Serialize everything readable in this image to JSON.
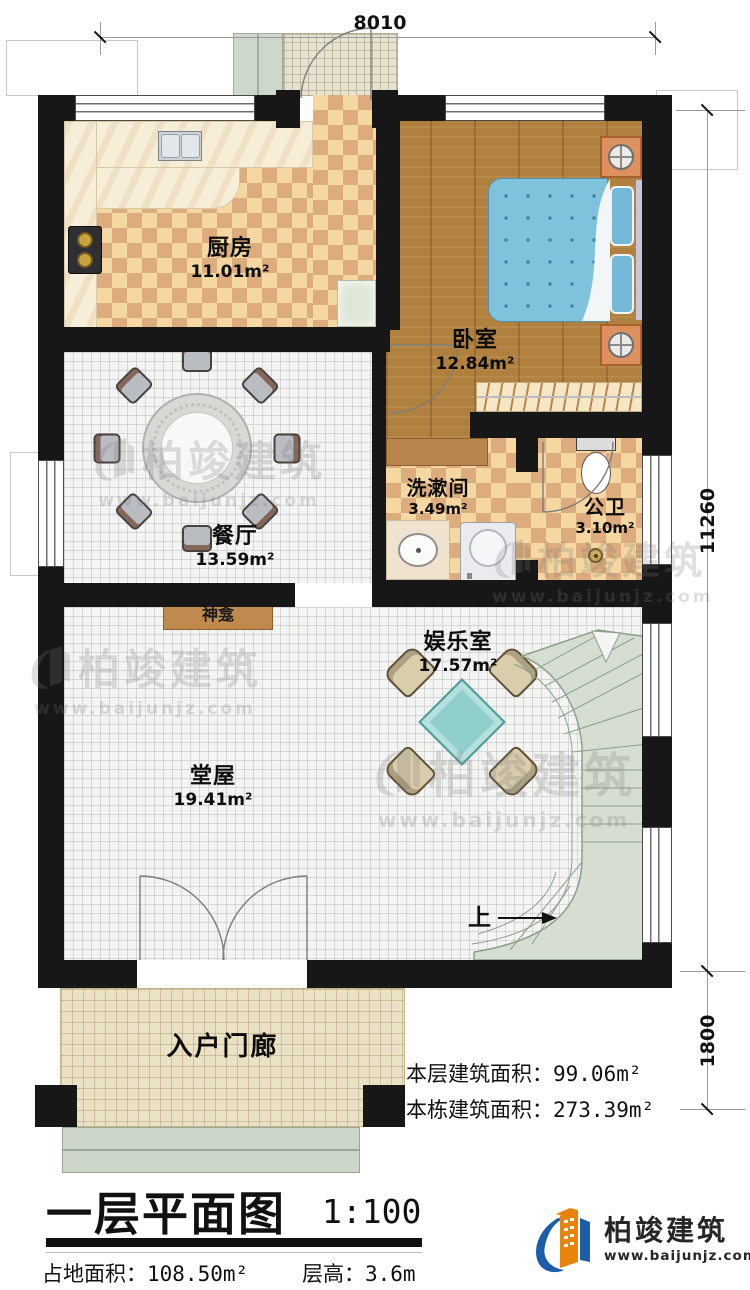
{
  "dims": {
    "top": "8010",
    "right_main": "11260",
    "right_porch": "1800"
  },
  "rooms": {
    "kitchen": {
      "name": "厨房",
      "area": "11.01m²"
    },
    "bedroom": {
      "name": "卧室",
      "area": "12.84m²"
    },
    "dining": {
      "name": "餐厅",
      "area": "13.59m²"
    },
    "washroom": {
      "name": "洗漱间",
      "area": "3.49m²"
    },
    "wc": {
      "name": "公卫",
      "area": "3.10m²"
    },
    "entertainment": {
      "name": "娱乐室",
      "area": "17.57m²"
    },
    "hall": {
      "name": "堂屋",
      "area": "19.41m²"
    },
    "porch": {
      "name": "入户门廊"
    },
    "shrine": {
      "name": "神龛"
    }
  },
  "stairs": {
    "up": "上"
  },
  "areas": {
    "floor_label": "本层建筑面积：",
    "floor_value": "99.06m²",
    "building_label": "本栋建筑面积：",
    "building_value": "273.39m²"
  },
  "titleblock": {
    "title": "一层平面图",
    "scale": "1:100",
    "land_label": "占地面积：",
    "land_value": "108.50m²",
    "height_label": "层高：",
    "height_value": "3.6m"
  },
  "brand": {
    "name": "柏竣建筑",
    "url": "www.baijunjz.com"
  },
  "watermark": {
    "name": "柏竣建筑",
    "url": "www.baijunjz.com"
  },
  "colors": {
    "wall": "#171717",
    "checker_light": "#f4d7a1",
    "checker_dark": "#dcab7e",
    "wood": "#b0803f",
    "bed_blue": "#7fc2dc",
    "stair_green": "#d6ded2",
    "brand_blue": "#1d5da8",
    "brand_orange": "#e8830b"
  }
}
